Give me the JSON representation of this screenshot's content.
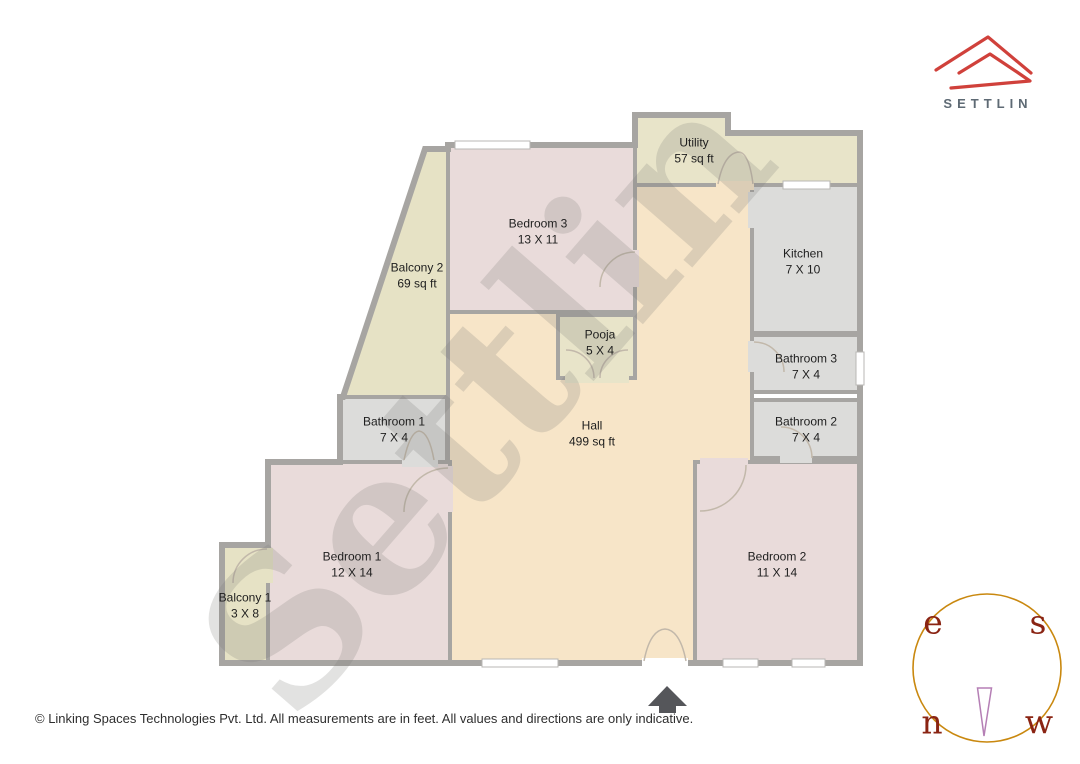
{
  "brand": {
    "logo_text": "SETTLIN",
    "logo_color": "#d0413b"
  },
  "watermark_text": "Settlin",
  "rooms": [
    {
      "key": "utility",
      "name": "Utility",
      "dims": "57 sq ft"
    },
    {
      "key": "kitchen",
      "name": "Kitchen",
      "dims": "7 X 10"
    },
    {
      "key": "bedroom3",
      "name": "Bedroom 3",
      "dims": "13 X 11"
    },
    {
      "key": "balcony2",
      "name": "Balcony 2",
      "dims": "69 sq ft"
    },
    {
      "key": "pooja",
      "name": "Pooja",
      "dims": "5 X 4"
    },
    {
      "key": "bathroom3",
      "name": "Bathroom 3",
      "dims": "7 X 4"
    },
    {
      "key": "bathroom2",
      "name": "Bathroom 2",
      "dims": "7 X 4"
    },
    {
      "key": "bathroom1",
      "name": "Bathroom 1",
      "dims": "7 X 4"
    },
    {
      "key": "hall",
      "name": "Hall",
      "dims": "499 sq ft"
    },
    {
      "key": "bedroom1",
      "name": "Bedroom 1",
      "dims": "12 X 14"
    },
    {
      "key": "bedroom2",
      "name": "Bedroom 2",
      "dims": "11 X 14"
    },
    {
      "key": "balcony1",
      "name": "Balcony 1",
      "dims": "3 X 8"
    }
  ],
  "compass": {
    "east": "e",
    "south": "s",
    "north": "n",
    "west": "w"
  },
  "footer": {
    "copyright": "© Linking Spaces Technologies Pvt. Ltd. All measurements are in feet. All values and directions are only indicative."
  },
  "colors": {
    "hall_floor": "#f7e5c8",
    "bedroom_floor": "#e9dbda",
    "wet_area_floor": "#dcdcda",
    "balcony_floor": "#e8e4c9",
    "walls": "#a7a5a2",
    "logo_red": "#d0413b",
    "compass_ring": "#c9880f",
    "compass_letters": "#8a2413",
    "compass_needle": "#b57fb5",
    "entrance_arrow": "#55565a"
  }
}
